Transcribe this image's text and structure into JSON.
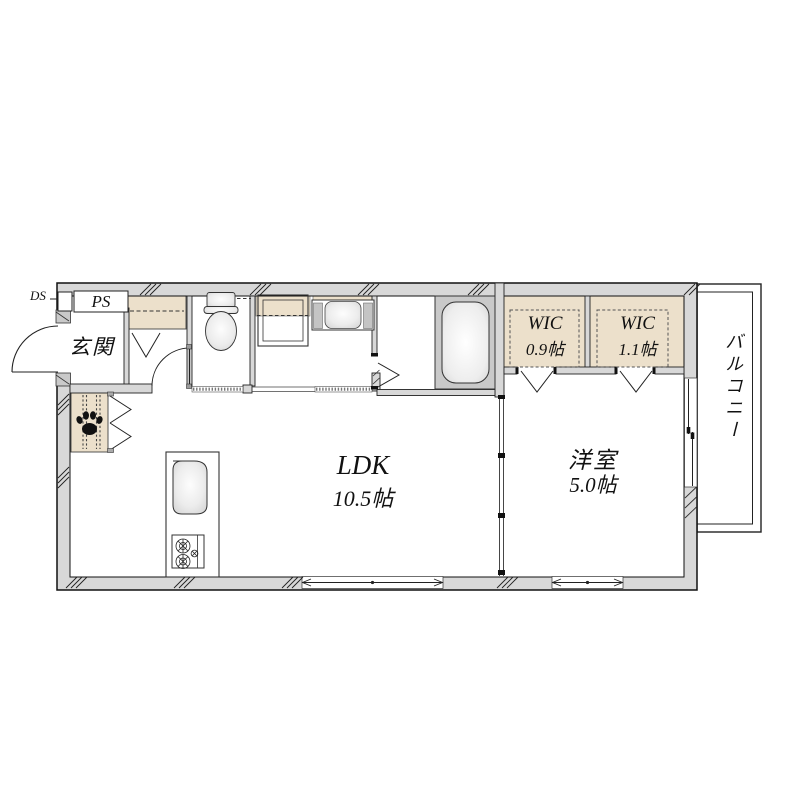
{
  "plan": {
    "type": "apartment-floor-plan",
    "rooms": {
      "entrance": {
        "label": "玄関"
      },
      "ldk": {
        "label": "LDK",
        "size": "10.5帖"
      },
      "western_room": {
        "label": "洋室",
        "size": "5.0帖"
      },
      "wic_left": {
        "label": "WIC",
        "size": "0.9帖"
      },
      "wic_right": {
        "label": "WIC",
        "size": "1.1帖"
      },
      "balcony": {
        "label": "バルコニー"
      },
      "pipe_space": {
        "label": "PS"
      },
      "duct_space": {
        "label": "DS"
      }
    },
    "fixtures": [
      "entrance-door-swing",
      "shoe-cabinet",
      "toilet",
      "washing-machine-pan",
      "shelf",
      "vanity-sink",
      "bathtub",
      "kitchen-counter",
      "kitchen-sink",
      "gas-stove",
      "pet-space-paw-print",
      "sliding-partition",
      "folding-doors",
      "windows",
      "wall-hatch-marks"
    ],
    "colors": {
      "wall_fill": "#d8d8d8",
      "storage_fill": "#ece0cb",
      "fixture_gray": "#c9c9c9",
      "line": "#1a1a1a",
      "background": "#ffffff"
    }
  }
}
